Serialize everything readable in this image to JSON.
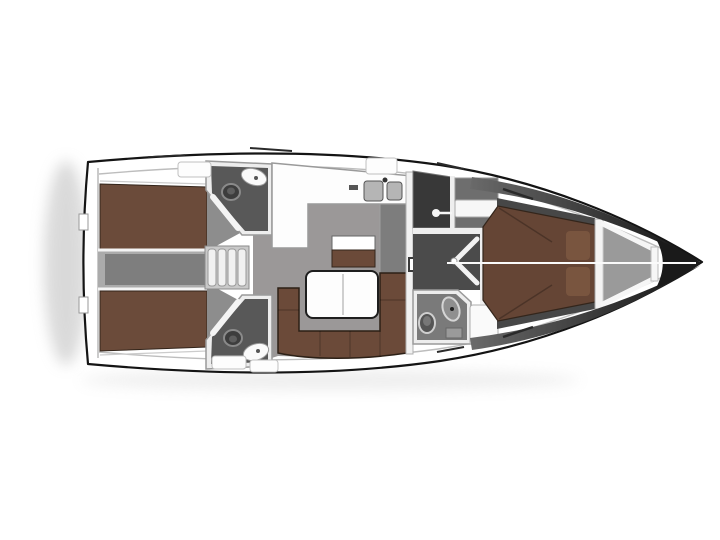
{
  "diagram": {
    "type": "yacht-floor-plan",
    "view": "top-down interior layout",
    "orientation": "bow-right-stern-left"
  },
  "colors": {
    "background": "#ffffff",
    "hull_outline": "#141414",
    "inner_wall": "#bdbdbd",
    "floor_grey": "#9b9898",
    "corridor_grey": "#7e7e7e",
    "corridor_base": "#ababab",
    "berth_brown": "#6b4b3a",
    "sofa_brown": "#6b4a39",
    "bed_brown": "#654535",
    "pillow_brown": "#79553f",
    "head_floor": "#585858",
    "head_wall": "#ededed",
    "dark_room": "#383838",
    "passage_dark": "#4b4b4b",
    "furniture_white": "#fdfdfd",
    "fixture_grey": "#8f8f8f",
    "sink_grey": "#b5b5b5",
    "anchor_locker_grey": "#9a9a9a",
    "bow_tip_dark": "#1a1a1a",
    "steps_base": "#c9c9c9",
    "step_tread": "#f1f1f1",
    "sideboard_grey": "#7d7d7d",
    "wardrobe_grey": "#6e6e6e",
    "toilet_dark": "#3d3d3d",
    "shelf_strip_dark": "#474747"
  },
  "rooms": [
    {
      "name": "aft-cabin-port",
      "feature": "double-berth"
    },
    {
      "name": "aft-cabin-starboard",
      "feature": "double-berth"
    },
    {
      "name": "engine-corridor",
      "feature": "between-aft-cabins"
    },
    {
      "name": "companionway-steps",
      "feature": "4-treads"
    },
    {
      "name": "aft-head-port",
      "fixtures": [
        "toilet",
        "sink",
        "door"
      ]
    },
    {
      "name": "aft-head-starboard",
      "fixtures": [
        "toilet",
        "sink",
        "door"
      ]
    },
    {
      "name": "galley",
      "fixtures": [
        "l-counter",
        "double-sink",
        "faucet"
      ]
    },
    {
      "name": "salon",
      "furniture": [
        "u-sofa",
        "folding-table",
        "stool-seat",
        "sideboard"
      ]
    },
    {
      "name": "mast-post"
    },
    {
      "name": "shower-room-port",
      "fixtures": [
        "door-handle"
      ]
    },
    {
      "name": "wardrobe-nook"
    },
    {
      "name": "forward-passage",
      "fixtures": [
        "double-door"
      ]
    },
    {
      "name": "forward-head",
      "fixtures": [
        "toilet",
        "sink",
        "shower-grate"
      ]
    },
    {
      "name": "owner-cabin",
      "feature": "v-berth",
      "furniture": [
        "pillows",
        "side-shelves",
        "headboard"
      ]
    },
    {
      "name": "anchor-locker"
    },
    {
      "name": "bow-tip"
    }
  ]
}
